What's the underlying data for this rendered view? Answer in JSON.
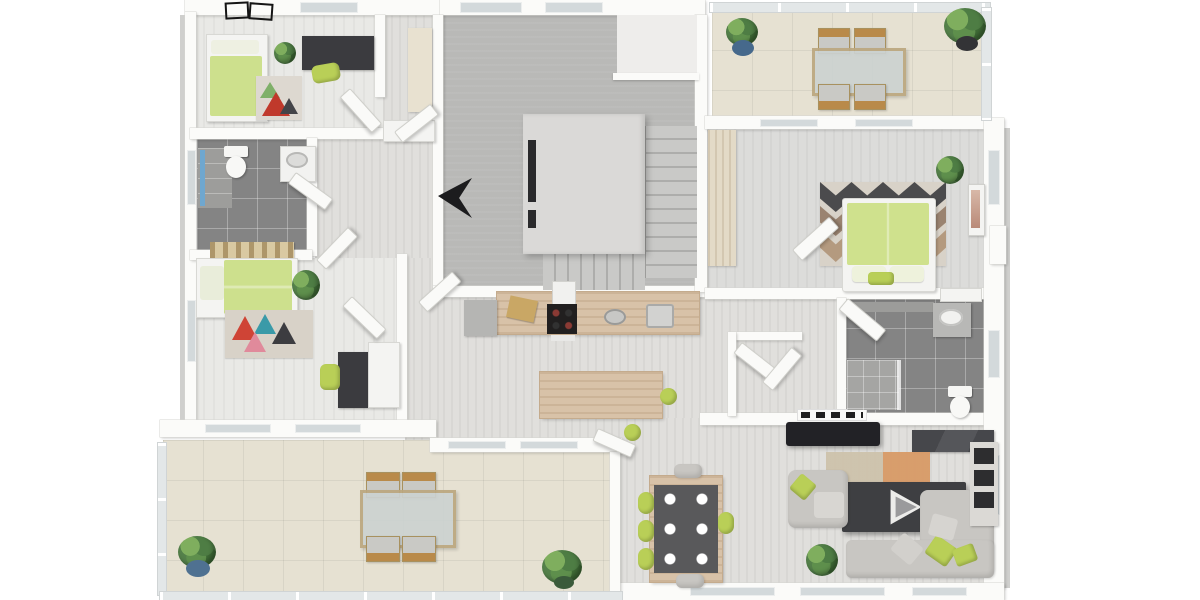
{
  "scene": {
    "title": "3D floor plan - top-down rendering of an apartment storey",
    "background": "#ffffff",
    "view": "isometric top-down",
    "watermark": "play-button logo on coffee table"
  },
  "palette": {
    "wall_white": "#fbfbf9",
    "carpet_gray": "#b9b9b7",
    "floor_light": "#e9e9e6",
    "floor_wood": "#e0dfdc",
    "tile_dark_gray": "#848484",
    "terrace_tile_beige": "#e6e1d2",
    "counter_wood": "#d8c2a8",
    "accent_lime": "#b9cf57",
    "duvet_green": "#cde08d",
    "sofa_gray": "#c8c6c2",
    "coffee_table_dark": "#3e3f42",
    "tv_black": "#222226",
    "plant_green": "#4e7d44",
    "pot_blue": "#46698c",
    "shower_glass_blue": "#6fa7cf",
    "window_glass": "#d3d9db"
  },
  "rooms": [
    {
      "id": "bedroom-1",
      "label": "Bedroom 1 (top left)",
      "floor": "light gray carpet"
    },
    {
      "id": "bathroom-1",
      "label": "Bathroom left",
      "floor": "dark gray tile"
    },
    {
      "id": "bedroom-2",
      "label": "Bedroom 2 (left)",
      "floor": "light gray carpet"
    },
    {
      "id": "hallway",
      "label": "Hallway with open doors",
      "floor": "light wood"
    },
    {
      "id": "stair-room",
      "label": "Stair room / landing",
      "floor": "gray carpet"
    },
    {
      "id": "open-kitchen-dining",
      "label": "Open kitchen and dining area",
      "floor": "light wood"
    },
    {
      "id": "master-bedroom",
      "label": "Master bedroom",
      "floor": "gray carpet"
    },
    {
      "id": "bathroom-2",
      "label": "Bathroom right",
      "floor": "dark gray tile"
    },
    {
      "id": "living-room",
      "label": "Living room",
      "floor": "light wood"
    },
    {
      "id": "terrace-top",
      "label": "Terrace top right with dining set",
      "floor": "beige tile"
    },
    {
      "id": "terrace-bottom",
      "label": "Large terrace bottom left",
      "floor": "beige tile"
    },
    {
      "id": "vestibule",
      "label": "Small vestibule with doors",
      "floor": "light wood"
    }
  ],
  "furniture": {
    "bedroom_1": [
      "single-bed green duvet",
      "multicolor rug",
      "potted plant",
      "dark desk",
      "lime desk chair",
      "roof-window symbols"
    ],
    "bathroom_1": [
      "toilet",
      "washbasin cabinet",
      "shower with blue glass"
    ],
    "bedroom_2": [
      "single-bed green duvet",
      "gold headboard art",
      "triangle-pattern rug",
      "potted plant",
      "dark desk",
      "lime chair",
      "white wardrobe"
    ],
    "hallway": [
      "white sideboard",
      "tall beige cabinet",
      "five open door leaves",
      "dark open-door wedge"
    ],
    "stair_room": [
      "central stair block",
      "stair treads right",
      "stair treads bottom",
      "upper landing with railing"
    ],
    "kitchen": [
      "wood counter",
      "gray end cabinet",
      "coffee machine",
      "cutting board",
      "cooktop 4 burners",
      "round sink",
      "second sink",
      "wood island bar",
      "2 lime bar stools"
    ],
    "dining": [
      "dark dining table",
      "6 white plates",
      "4 lime chairs",
      "2 gray chairs"
    ],
    "living_room": [
      "wall radiator",
      "flatscreen TV",
      "dark media sideboard",
      "beige-orange rug",
      "dark coffee table with play logo",
      "gray armchair",
      "gray corner sofa",
      "gray bottom sofa",
      "lime pillows",
      "potted plant",
      "shelf unit with dark boxes"
    ],
    "master_bedroom": [
      "wood wardrobe strip",
      "chevron rug",
      "double bed green duvet",
      "two pillows",
      "lime cushion",
      "potted plant",
      "wall art",
      "open door"
    ],
    "bathroom_2": [
      "gray counter strip",
      "vanity with basin",
      "wall cabinet",
      "shower corner",
      "toilet",
      "open door"
    ],
    "terrace_top": [
      "4 wood chairs",
      "outdoor table",
      "plant in blue pot",
      "plant in dark pot",
      "glass railing"
    ],
    "terrace_bottom": [
      "4 wood chairs",
      "glass outdoor table",
      "plant in blue pot",
      "green plant",
      "glass railing"
    ]
  }
}
